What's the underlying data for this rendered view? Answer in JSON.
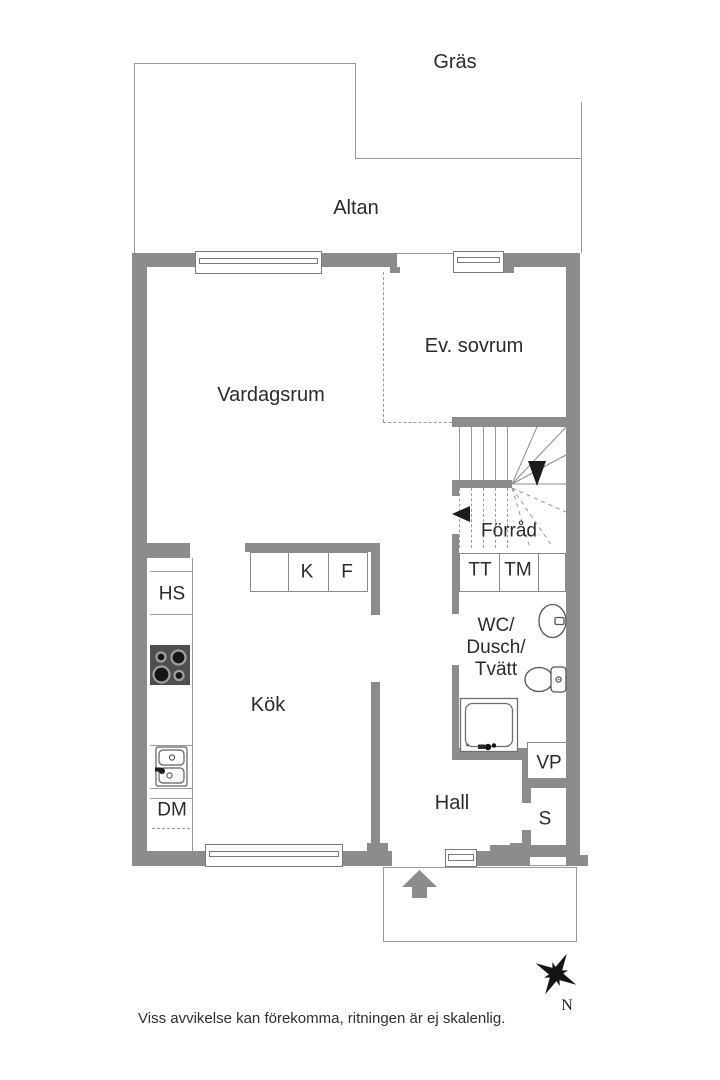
{
  "disclaimer": "Viss avvikelse kan förekomma, ritningen är ej skalenlig.",
  "compass": {
    "north": "N"
  },
  "areas": {
    "gras": "Gräs",
    "altan": "Altan"
  },
  "rooms": {
    "vardagsrum": "Vardagsrum",
    "ev_sovrum": "Ev. sovrum",
    "forrad": "Förråd",
    "kok": "Kök",
    "hall": "Hall",
    "wc": [
      "WC/",
      "Dusch/",
      "Tvätt"
    ]
  },
  "fixtures": {
    "hs": "HS",
    "kyl": "K",
    "frys": "F",
    "tt": "TT",
    "tm": "TM",
    "dm": "DM",
    "vp": "VP",
    "s": "S"
  },
  "colors": {
    "wall": "#8c8c8c",
    "thin_line": "#9a9a9a",
    "text": "#2b2b2b",
    "stove": "#4f4f4f",
    "stair_arrow": "#1c1c1c",
    "entry_arrow": "#8c8c8c"
  }
}
